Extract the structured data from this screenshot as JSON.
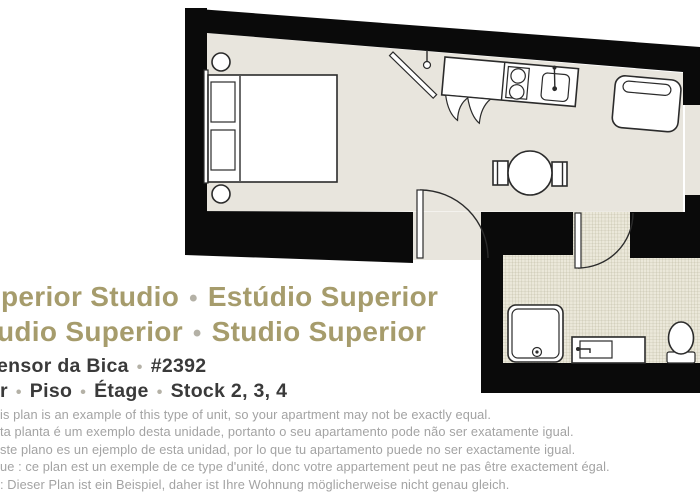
{
  "theme": {
    "background": "#ffffff",
    "wall": "#0a0a0a",
    "floor": "#e8e5dd",
    "tile": "#ebe8da",
    "tileGrid": "#b7b39a",
    "outline": "#2b2b2b",
    "furnitureFill": "#ffffff",
    "title": "#a69c6c",
    "subtitle": "#3a3a3a",
    "bullet": "#b4b1a6",
    "disclaimer": "#a3a3a3"
  },
  "floor_plan": {
    "type": "studio-apartment-plan",
    "rooms": [
      "studio-main-room",
      "bathroom"
    ],
    "furniture": [
      "double-bed",
      "pillows",
      "bedside-stool-top",
      "bedside-stool-bottom",
      "wall-mounted-tv",
      "kitchen-counter",
      "two-burner-stove",
      "kitchen-sink",
      "counter-flaps",
      "armchair",
      "round-dining-table",
      "table-stool-left",
      "table-stool-right",
      "entry-door",
      "bathroom-door",
      "shower",
      "vanity-sink",
      "toilet"
    ],
    "bathroom_floor": "tiled-grid"
  },
  "title": {
    "lines": [
      {
        "segments": [
          "perior Studio",
          "•",
          "Estúdio Superior"
        ]
      },
      {
        "segments": [
          "udio Superior",
          "•",
          "Studio Superior"
        ]
      }
    ]
  },
  "subtitle": {
    "lines": [
      {
        "segments": [
          "ensor da Bica",
          "•",
          "#2392"
        ]
      },
      {
        "segments": [
          "r",
          "•",
          "Piso",
          "•",
          "Étage",
          "•",
          "Stock 2, 3, 4"
        ]
      }
    ]
  },
  "disclaimer": {
    "lines": [
      "is plan is an example of this type of unit, so your apartment may not be exactly equal.",
      "ta planta é um exemplo desta unidade, portanto o seu apartamento pode não ser exatamente igual.",
      "ste plano es un ejemplo de esta unidad, por lo que tu apartamento puede no ser exactamente igual.",
      "ue : ce plan est un exemple de ce type d'unité, donc votre appartement peut ne pas être exactement égal.",
      ": Dieser Plan ist ein Beispiel, daher ist Ihre Wohnung möglicherweise nicht genau gleich."
    ]
  }
}
